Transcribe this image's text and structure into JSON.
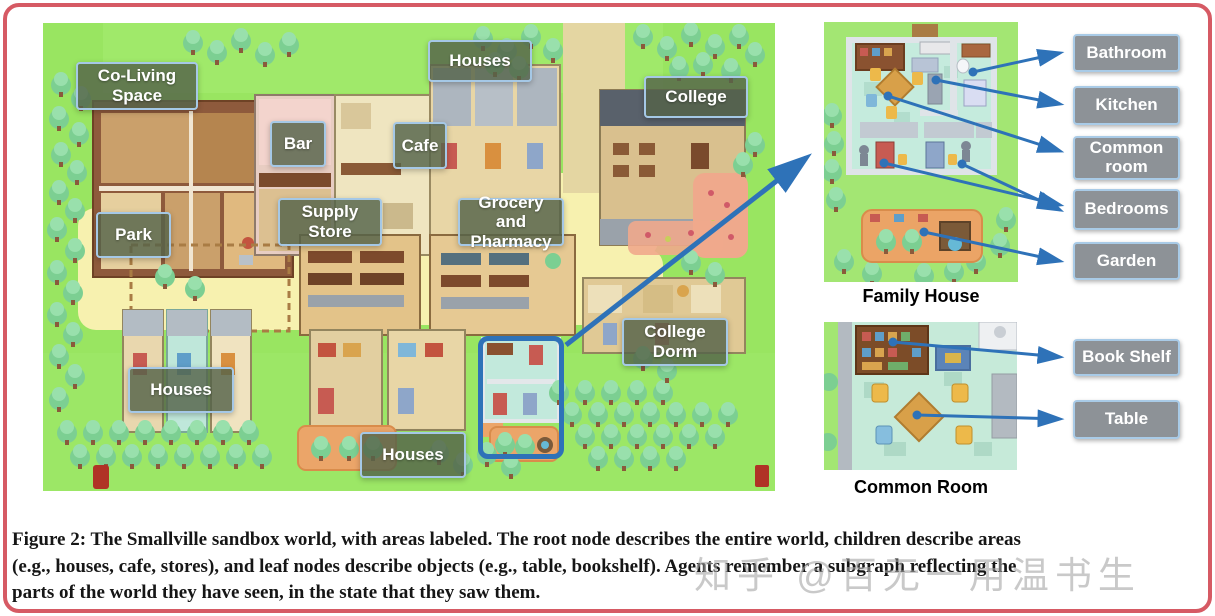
{
  "figure": {
    "caption_lines": [
      "Figure 2: The Smallville sandbox world, with areas labeled. The root node describes the entire world, children describe areas",
      "(e.g., houses, cafe, stores), and leaf nodes describe objects (e.g., table, bookshelf). Agents remember a subgraph reflecting the",
      "parts of the world they have seen, in the state that they saw them."
    ],
    "watermark": "知乎 @百无一用温书生"
  },
  "map_labels": [
    {
      "text": "Co-Living Space"
    },
    {
      "text": "Houses"
    },
    {
      "text": "Bar"
    },
    {
      "text": "Cafe"
    },
    {
      "text": "College"
    },
    {
      "text": "Park"
    },
    {
      "text": "Supply Store"
    },
    {
      "text": "Grocery and Pharmacy"
    },
    {
      "text": "Houses"
    },
    {
      "text": "College Dorm"
    },
    {
      "text": "Houses"
    }
  ],
  "annotations": {
    "family_house": {
      "caption": "Family House",
      "labels": [
        {
          "text": "Bathroom"
        },
        {
          "text": "Kitchen"
        },
        {
          "text": "Common room"
        },
        {
          "text": "Bedrooms"
        },
        {
          "text": "Garden"
        }
      ]
    },
    "common_room": {
      "caption": "Common Room",
      "labels": [
        {
          "text": "Book Shelf"
        },
        {
          "text": "Table"
        }
      ]
    }
  },
  "colors": {
    "arrow_blue": "#2e72b8",
    "border_red": "#d65a64",
    "map_label_olive": "#546349",
    "room_label_gray": "#8d9297",
    "grass_green": "#99e561",
    "path_yellow": "#f7f1af"
  }
}
